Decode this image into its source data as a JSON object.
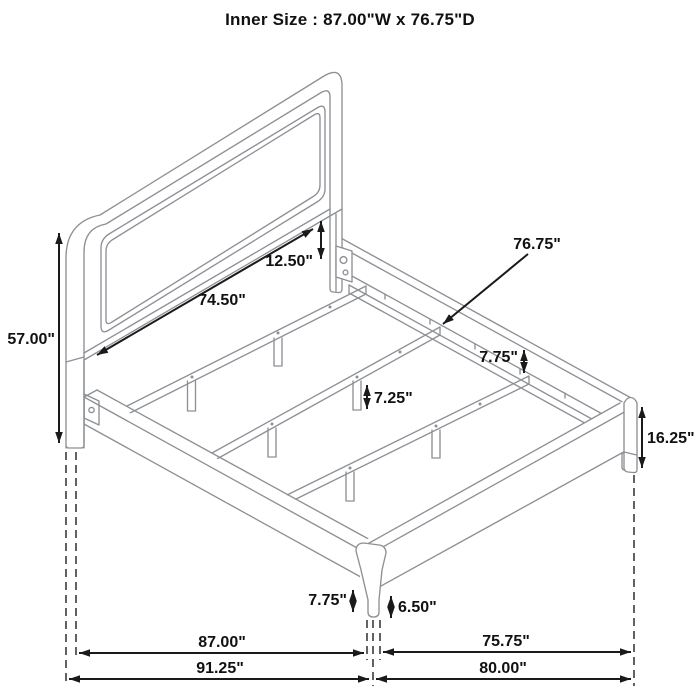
{
  "title": "Inner Size : 87.00\"W x 76.75\"D",
  "diagram": {
    "type": "isometric dimension drawing of a platform bed frame with upholstered headboard",
    "dimensions": {
      "headboard_height": "57.00\"",
      "headboard_inner_width": "74.50\"",
      "headboard_panel_to_rail_gap": "12.50\"",
      "slat_length": "76.75\"",
      "rail_top_to_slat_drop": "7.75\"",
      "center_support_leg_height": "7.25\"",
      "side_rail_with_leg_height": "16.25\"",
      "corner_leg_height": "7.75\"",
      "corner_leg_exposed_height": "6.50\"",
      "inner_width": "87.00\"",
      "overall_width": "91.25\"",
      "inner_depth": "75.75\"",
      "overall_depth": "80.00\""
    },
    "colors": {
      "furniture_line": "#8d9095",
      "dimension_line": "#1a1a1a",
      "label_text": "#111111",
      "background": "#ffffff"
    }
  }
}
